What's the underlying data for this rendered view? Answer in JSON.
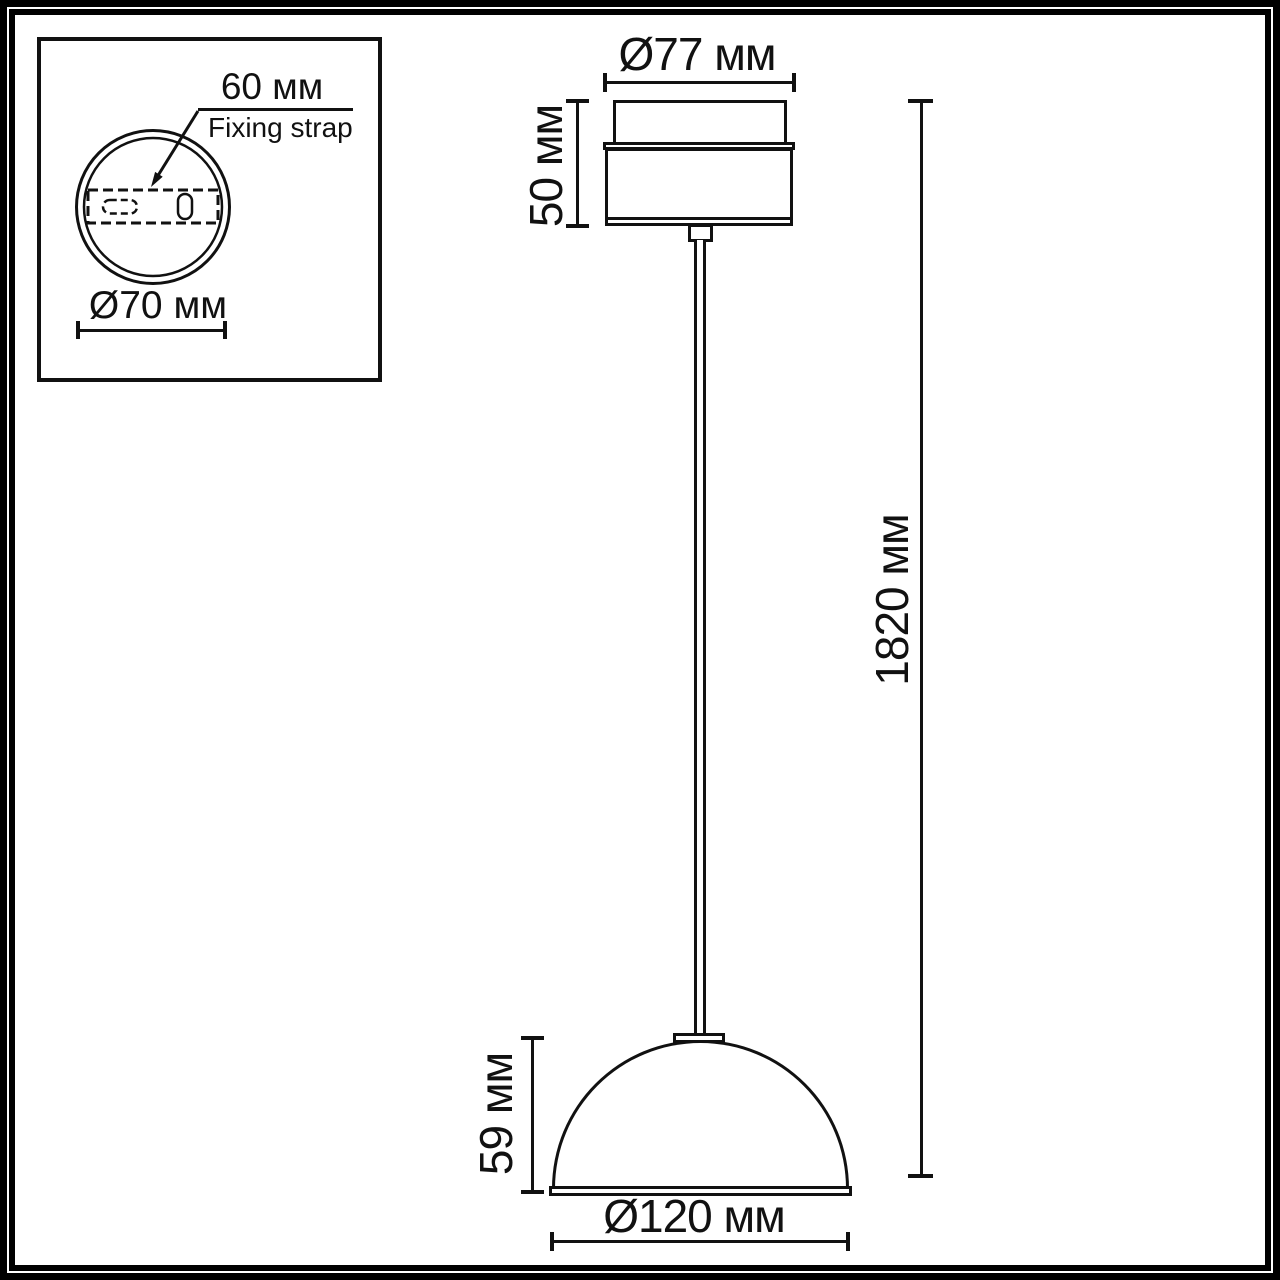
{
  "drawing_type": "pendant-lamp-dimension-diagram",
  "colors": {
    "line": "#111111",
    "background": "#ffffff"
  },
  "inset": {
    "strap_width_label": "60 мм",
    "strap_name_label": "Fixing strap",
    "base_diameter_label": "Ø70 мм"
  },
  "pendant": {
    "canopy_diameter_label": "Ø77 мм",
    "canopy_height_label": "50 мм",
    "overall_height_label": "1820 мм",
    "shade_height_label": "59 мм",
    "shade_diameter_label": "Ø120 мм"
  }
}
